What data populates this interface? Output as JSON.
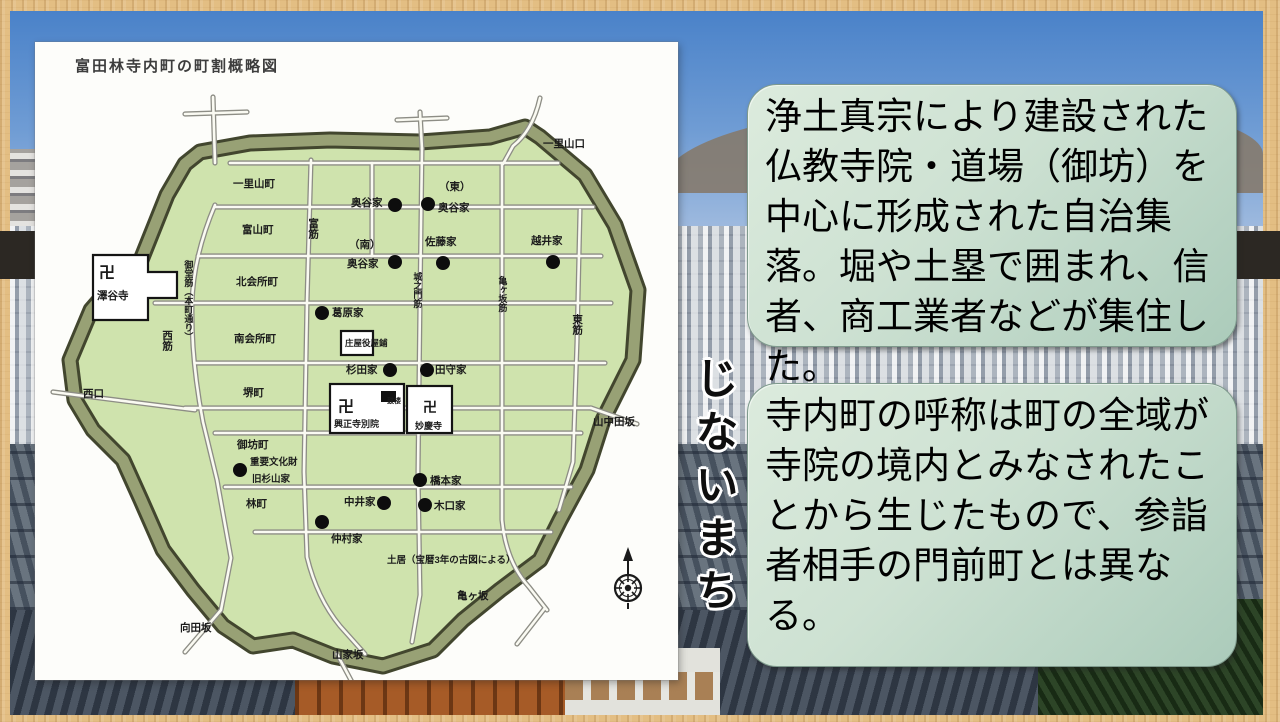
{
  "map": {
    "title": "富田林寺内町の町割概略図",
    "note": "土居（宝暦3年の古図による）",
    "labels": {
      "ichiriyamacho": "一里山町",
      "tomiyamacho": "富山町",
      "kitakaishocho": "北会所町",
      "minamikaishocho": "南会所町",
      "sakaicho": "堺町",
      "gobocho": "御坊町",
      "hayashicho": "林町",
      "nishisuji": "西筋",
      "midosuji": "御堂筋（本町通り）",
      "tomisuji": "富筋",
      "jonomonsuji": "城之門筋",
      "kamegasakasuji": "亀ヶ坂筋",
      "higashisuji": "東筋",
      "nishiguchi": "西口",
      "ichiriyamaguchi": "一里山口",
      "kamegasaka": "亀ヶ坂",
      "yamaiezaka": "山家坂",
      "mukaidazaka": "向田坂",
      "yamanakadazaka": "山中田坂",
      "manji": "卍",
      "sawatanidera": "澤谷寺",
      "koshoji_betsuin": "興正寺別院",
      "koro": "鼓楼",
      "myokeiji": "妙慶寺",
      "okutani": "奥谷家",
      "higashi_paren": "（東）",
      "minami_paren": "（南）",
      "satoke": "佐藤家",
      "koshiike": "越井家",
      "kuzuharake": "葛原家",
      "shoyayashiki": "庄屋役屋鋪",
      "sugitake": "杉田家",
      "tamorike": "田守家",
      "juyobunkazai": "重要文化財",
      "kyusugiyamake": "旧杉山家",
      "nakamurake": "仲村家",
      "nakaike": "中井家",
      "hashimotoke": "橋本家",
      "kiguchike": "木口家"
    }
  },
  "vertical_title": "じないまち",
  "callouts": {
    "box1": "浄土真宗により建設された仏教寺院・道場（御坊）を中心に形成された自治集落。堀や土塁で囲まれ、信者、商工業者などが集住した。",
    "box2": "寺内町の呼称は町の全域が寺院の境内とみなされたことから生じたもので、参詣者相手の門前町とは異なる。"
  }
}
